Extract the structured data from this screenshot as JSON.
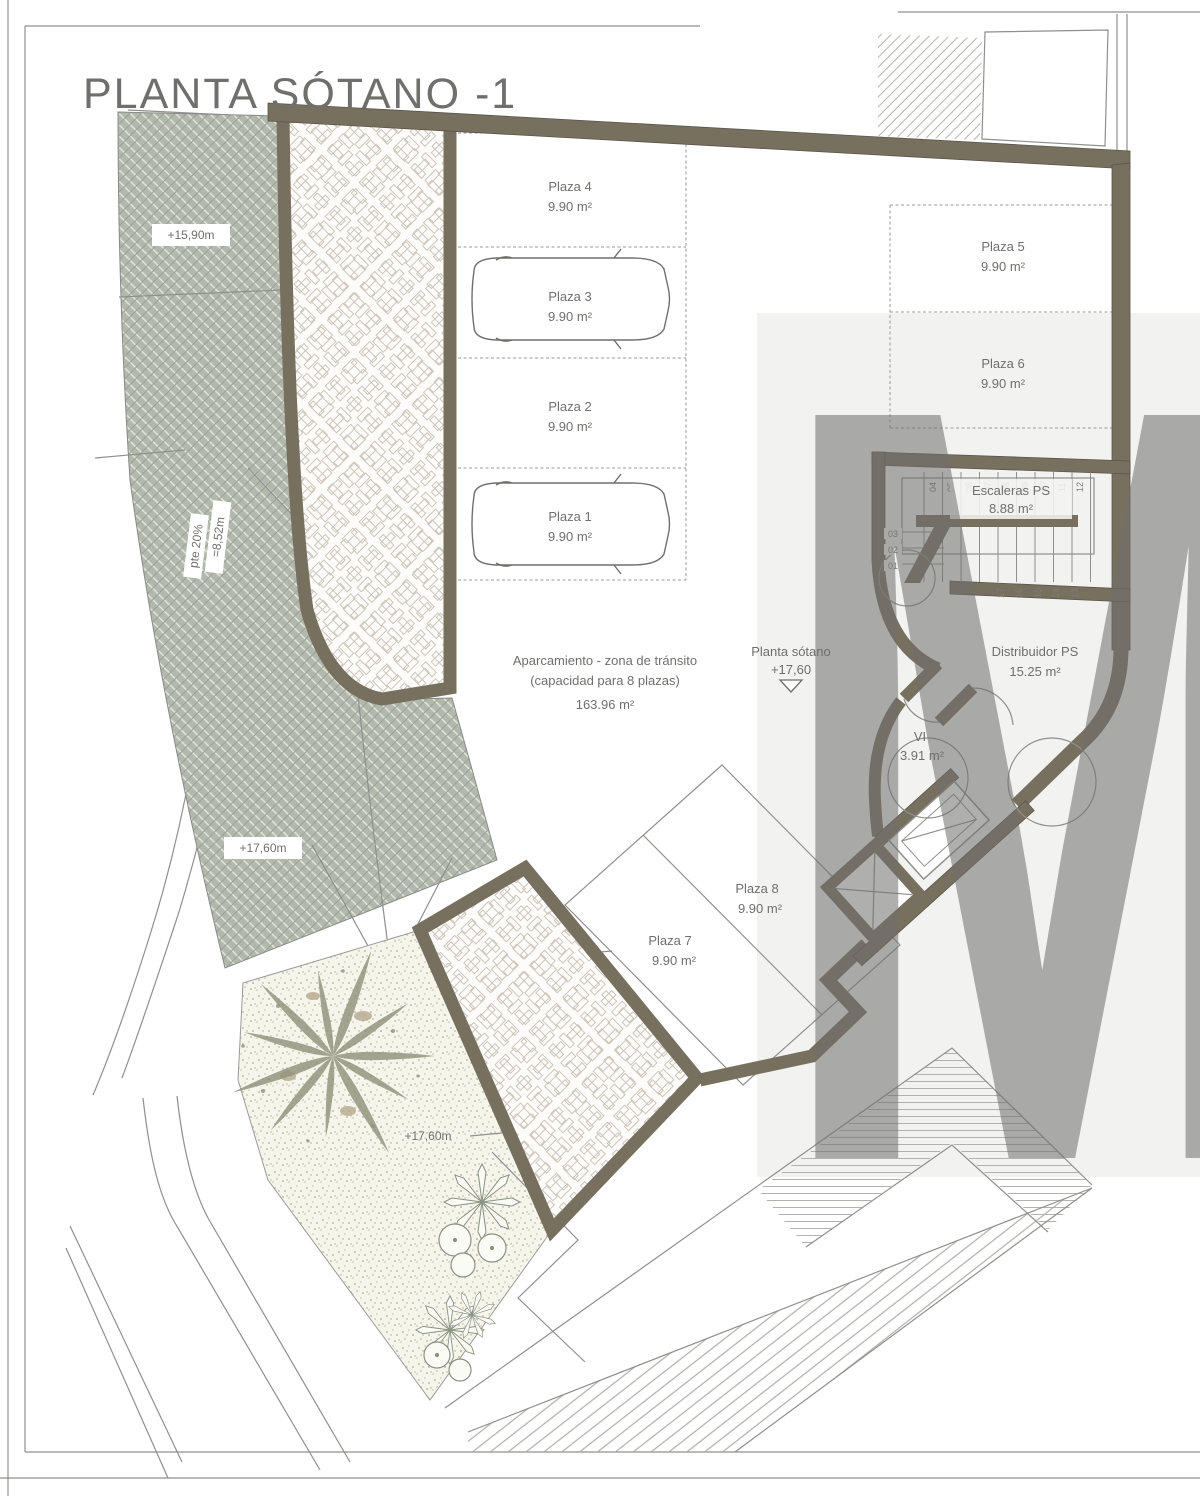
{
  "title": "PLANTA SÓTANO -1",
  "watermark": "M",
  "plazas": [
    {
      "name": "Plaza 1",
      "area": "9.90 m²"
    },
    {
      "name": "Plaza 2",
      "area": "9.90 m²"
    },
    {
      "name": "Plaza 3",
      "area": "9.90 m²"
    },
    {
      "name": "Plaza 4",
      "area": "9.90 m²"
    },
    {
      "name": "Plaza 5",
      "area": "9.90 m²"
    },
    {
      "name": "Plaza 6",
      "area": "9.90 m²"
    },
    {
      "name": "Plaza 7",
      "area": "9.90 m²"
    },
    {
      "name": "Plaza 8",
      "area": "9.90 m²"
    }
  ],
  "rooms": {
    "stairs": {
      "name": "Escaleras PS",
      "area": "8.88 m²"
    },
    "distribuidor": {
      "name": "Distribuidor PS",
      "area": "15.25 m²"
    },
    "vi": {
      "name": "VI",
      "area": "3.91 m²"
    },
    "aisle": {
      "line1": "Aparcamiento - zona de tránsito",
      "line2": "(capacidad para 8 plazas)",
      "area": "163.96 m²"
    }
  },
  "levels": {
    "ramp_top": "+15,90m",
    "ramp_len": "=8,52m",
    "ramp_slope": "pte 20%",
    "ramp_mid": "+17,60m",
    "garden": "+17,60m",
    "marker_name": "Planta sótano",
    "marker_value": "+17,60"
  },
  "stairs_numbers": {
    "top": [
      "04",
      "05",
      "06",
      "07",
      "08",
      "09",
      "10",
      "11",
      "12"
    ],
    "left": [
      "03",
      "02",
      "01"
    ],
    "bottom": [
      "17",
      "16",
      "15",
      "14",
      "13"
    ]
  },
  "colors": {
    "wall": "#78705f",
    "ramp": "#b2b9ac",
    "band": "#f2f2f0"
  }
}
